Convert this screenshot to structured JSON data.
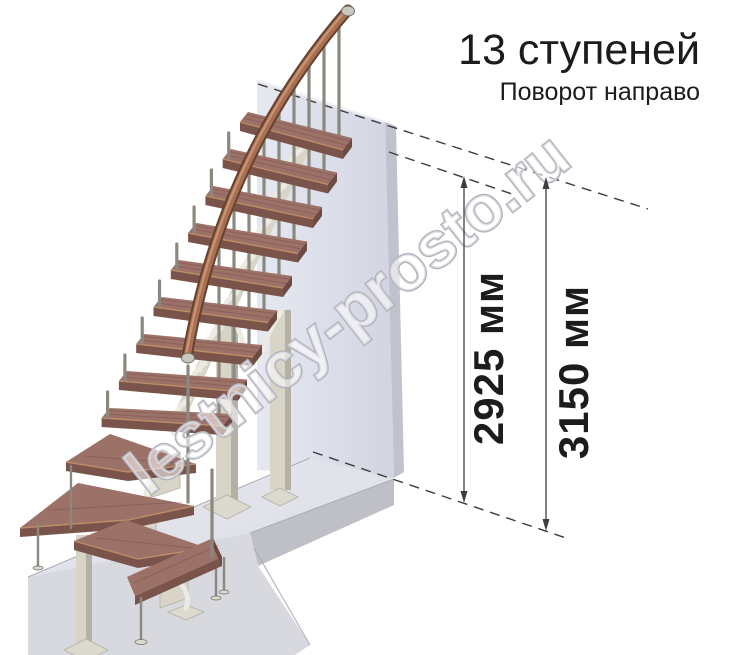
{
  "annotation": {
    "title": "13 ступеней",
    "subtitle": "Поворот направо",
    "steps_count": 13,
    "turn_direction": "направо"
  },
  "dimensions": {
    "inner": {
      "label": "2925 мм",
      "value_mm": 2925
    },
    "outer": {
      "label": "3150 мм",
      "value_mm": 3150
    }
  },
  "watermark": {
    "text": "lestnicy-prosto.ru"
  },
  "palette": {
    "ink": "#1c1c1c",
    "dash": "#3c3c3c",
    "dim": "#3f3f3f",
    "wood_top": "#9c7168",
    "wood_front": "#7a544b",
    "wood_end": "#6d4a42",
    "wood_edge_hl": "#c29066",
    "rail_outer": "#63422f",
    "rail_inner": "#a96f52",
    "rail_hl": "#cf9d7d",
    "metal_rod": "#8b897f",
    "metal_light": "#c9c7bf",
    "metal_dark": "#6f6d63",
    "beige": "#d8d4c8",
    "beige_dark": "#b4b0a3",
    "branch": "#ecebe2",
    "plate": "#dcd9cf",
    "wall": "#d9dbe6",
    "wall_light": "#e6e8f1",
    "wall_edge": "#c0c2ce",
    "floor_top": "#e4e5ec",
    "floor_front": "#d8d8df",
    "floor_right": "#bfbfc8",
    "floor_line": "#aaabb5",
    "wm_stroke": "#b2b2bc"
  }
}
